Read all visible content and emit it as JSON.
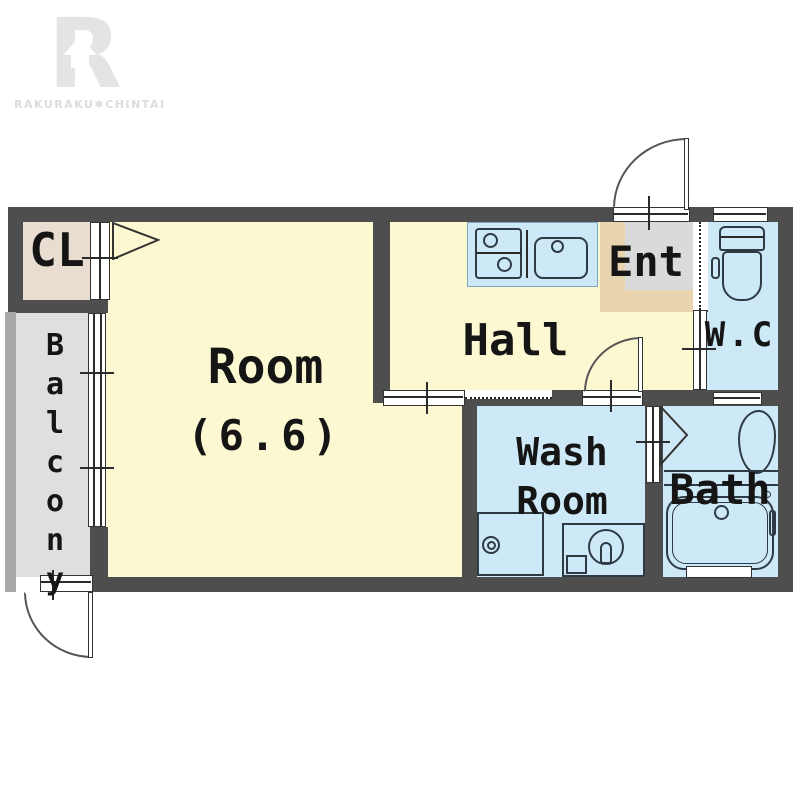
{
  "brand": {
    "logo_letter": "R",
    "logo_text": "RAKURAKU✱CHINTAI"
  },
  "rooms": {
    "cl": {
      "label": "CL"
    },
    "balcony": {
      "label": "Balcony"
    },
    "room": {
      "label": "Room",
      "size": "(6.6)"
    },
    "hall": {
      "label": "Hall"
    },
    "ent": {
      "label": "Ent"
    },
    "wc": {
      "label": "W.C"
    },
    "washroom": {
      "line1": "Wash",
      "line2": "Room"
    },
    "bath": {
      "label": "Bath"
    }
  },
  "fixtures": {
    "kitchen": "two-burner-stove-and-sink",
    "toilet": "toilet",
    "washing_machine": "washing-machine-pan",
    "washbasin": "washbasin",
    "bathtub": "bathtub"
  },
  "colors": {
    "wall": "#4e4e4e",
    "room_yellow": "#fcf8d2",
    "wet_blue": "#cde8f6",
    "closet_beige": "#e9dcd1",
    "entry_frame_beige": "#e8d4ae",
    "entry_gray": "#dadada",
    "balcony_gray": "#dfdfdf",
    "railing_gray": "#a8a8a8",
    "line": "#333333",
    "logo_gray": "#e3e3e3"
  }
}
